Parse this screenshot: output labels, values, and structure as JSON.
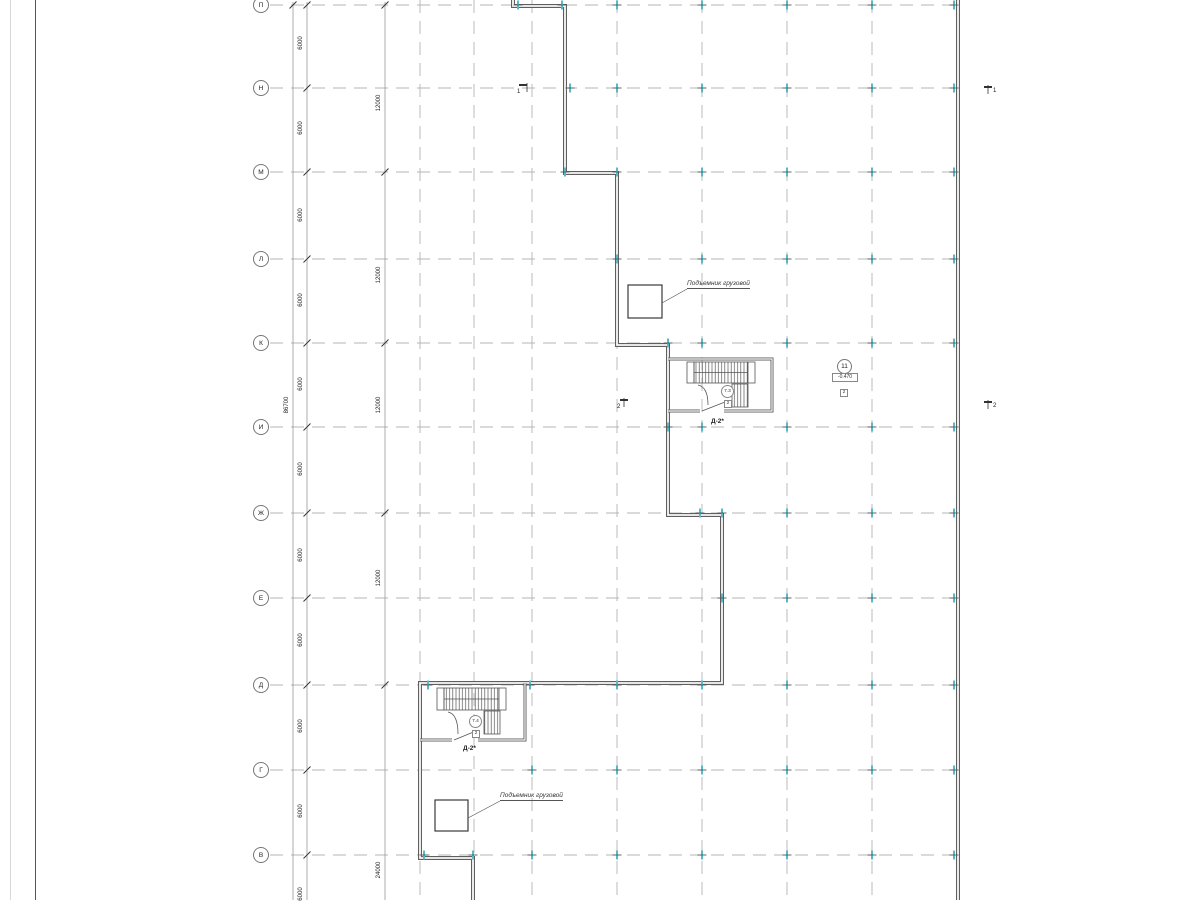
{
  "colors": {
    "wall": "#5f5f5f",
    "grid_line": "#b4b4b4",
    "column_tick": "#52bcc8",
    "dimension_line": "#9a9a9a",
    "text": "#1f1f1f"
  },
  "axes": {
    "rows": [
      "П",
      "Н",
      "М",
      "Л",
      "К",
      "И",
      "Ж",
      "Е",
      "Д",
      "Г",
      "В"
    ]
  },
  "dims": {
    "d6000": [
      "6000",
      "6000",
      "6000",
      "6000",
      "6000",
      "6000",
      "6000",
      "6000",
      "6000",
      "6000",
      "6000"
    ],
    "d12000": [
      "12000",
      "12000",
      "12000",
      "12000"
    ],
    "d24000": "24000",
    "overall": "86700"
  },
  "labels": {
    "lift1": "Подъемник грузовой",
    "lift2": "Подъемник грузовой",
    "door1": "Д-2*",
    "door2": "Д-2*",
    "room1_number": "7.3",
    "room1_sub": "2",
    "room2_number": "7.4",
    "room2_sub": "2",
    "axis_bubble": "11",
    "elevation": "-0.470",
    "elevation_sub": "2",
    "section1a": "1",
    "section1b": "1",
    "section2a": "2",
    "section2b": "2"
  },
  "drawing": {
    "row_ys": [
      5,
      88,
      172,
      259,
      343,
      427,
      513,
      598,
      685,
      770,
      855
    ],
    "column_xs": [
      420,
      474,
      532,
      617,
      702,
      787,
      872
    ],
    "ticks": [
      {
        "y": 5,
        "xs": [
          518,
          562,
          617,
          702,
          787,
          872,
          954
        ]
      },
      {
        "y": 88,
        "xs": [
          570,
          617,
          702,
          787,
          872,
          954
        ]
      },
      {
        "y": 172,
        "xs": [
          565,
          617,
          702,
          787,
          872,
          954
        ]
      },
      {
        "y": 259,
        "xs": [
          617,
          702,
          787,
          872,
          954
        ]
      },
      {
        "y": 343,
        "xs": [
          668,
          702,
          787,
          872,
          954
        ]
      },
      {
        "y": 427,
        "xs": [
          668,
          702,
          787,
          872,
          954
        ]
      },
      {
        "y": 513,
        "xs": [
          700,
          722,
          787,
          872,
          954
        ]
      },
      {
        "y": 598,
        "xs": [
          722,
          787,
          872,
          954
        ]
      },
      {
        "y": 685,
        "xs": [
          428,
          530,
          617,
          702,
          787,
          872,
          954
        ]
      },
      {
        "y": 770,
        "xs": [
          532,
          617,
          702,
          787,
          872,
          954
        ]
      },
      {
        "y": 855,
        "xs": [
          424,
          473,
          532,
          617,
          702,
          787,
          872,
          954
        ]
      }
    ],
    "dim_slashes": [
      {
        "x": 307,
        "ys": [
          5,
          88,
          172,
          259,
          343,
          427,
          513,
          598,
          685,
          770,
          855
        ]
      },
      {
        "x": 385,
        "ys": [
          5,
          172,
          343,
          513,
          685
        ]
      },
      {
        "x": 293,
        "ys": [
          5
        ]
      }
    ]
  }
}
